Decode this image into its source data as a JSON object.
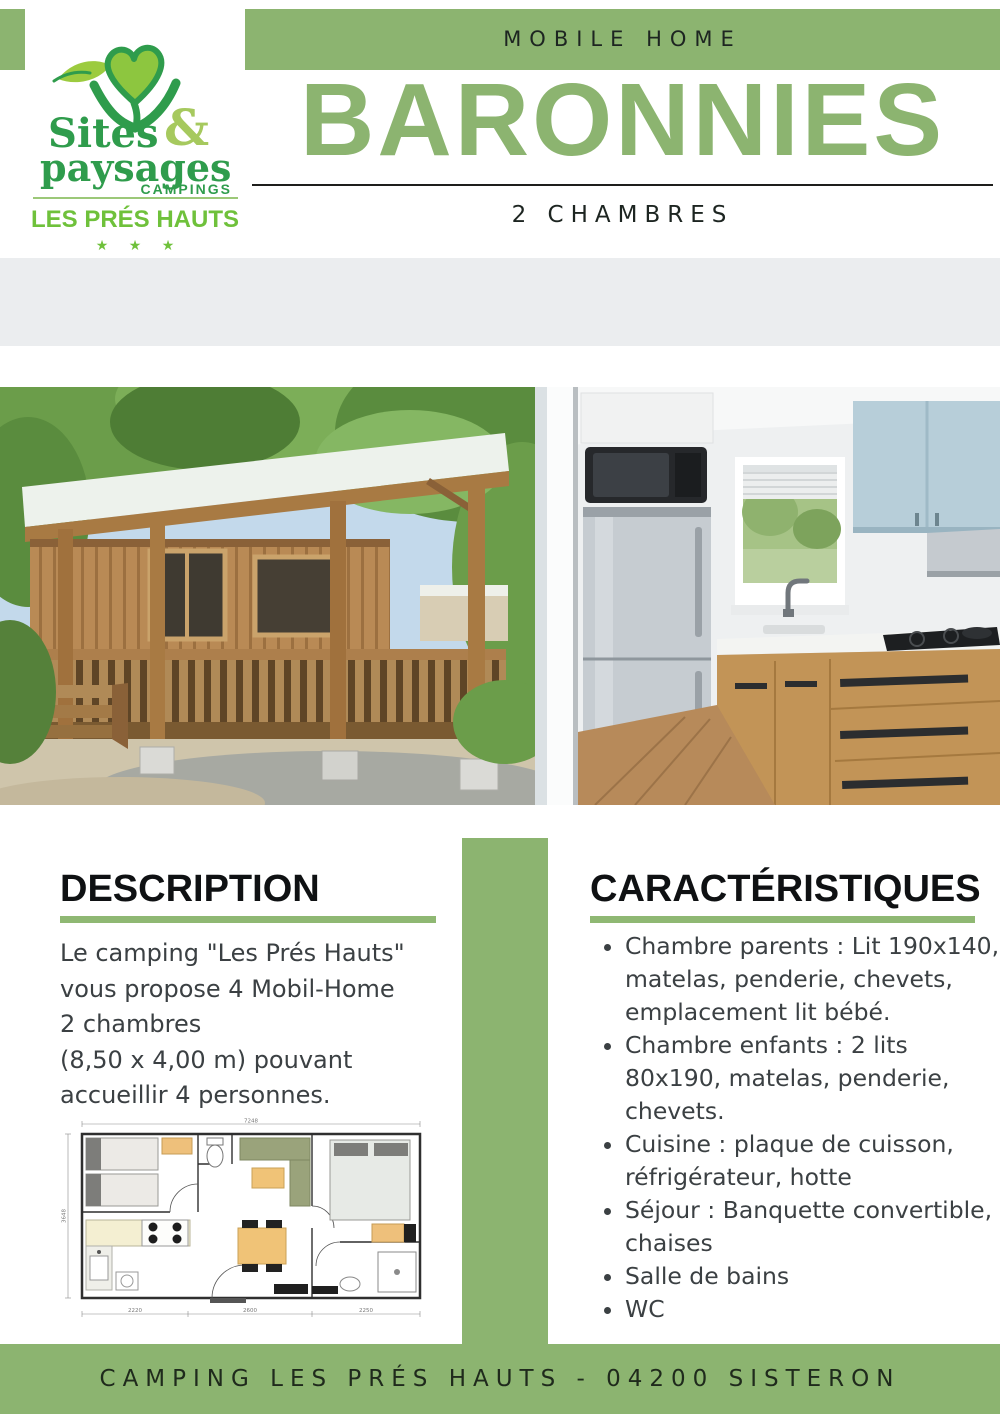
{
  "brand": {
    "sites": "Sites",
    "amp": "&",
    "paysages": "paysages",
    "campings": "CAMPINGS",
    "site_name": "LES PRÉS HAUTS",
    "stars": "★ ★ ★"
  },
  "header": {
    "category": "MOBILE HOME",
    "title": "BARONNIES",
    "subtitle": "2 CHAMBRES"
  },
  "specs": {
    "area": {
      "icon": "house-m2-icon",
      "icon_text": "m²",
      "label": "29 m2"
    },
    "capacity": {
      "icon": "bed-icon",
      "label": "4 personnes"
    }
  },
  "description": {
    "heading": "DESCRIPTION",
    "lines": [
      "Le camping \"Les Prés Hauts\"",
      "vous propose 4 Mobil-Home",
      "2 chambres",
      "(8,50 x 4,00 m) pouvant",
      "accueillir 4 personnes."
    ]
  },
  "features": {
    "heading": "CARACTÉRISTIQUES",
    "items": [
      "Chambre parents : Lit 190x140, matelas, penderie, chevets, emplacement lit bébé.",
      "Chambre enfants : 2 lits 80x190, matelas, penderie, chevets.",
      "Cuisine : plaque de cuisson, réfrigérateur, hotte",
      "Séjour : Banquette convertible, chaises",
      "Salle de bains",
      "WC"
    ]
  },
  "floorplan": {
    "dim_top": "7248",
    "dim_left": "3648",
    "dim_bottom_1": "2220",
    "dim_bottom_2": "2600",
    "dim_bottom_3": "2250"
  },
  "footer": {
    "text": "CAMPING LES PRÉS HAUTS - 04200 SISTERON"
  },
  "colors": {
    "sage_green": "#8cb470",
    "bright_green": "#6fc13b",
    "logo_green": "#2f9c4c",
    "logo_light_green": "#8dc63f",
    "band_gray": "#ebedef",
    "text_dark": "#1d2521",
    "body_text": "#3b4043"
  }
}
